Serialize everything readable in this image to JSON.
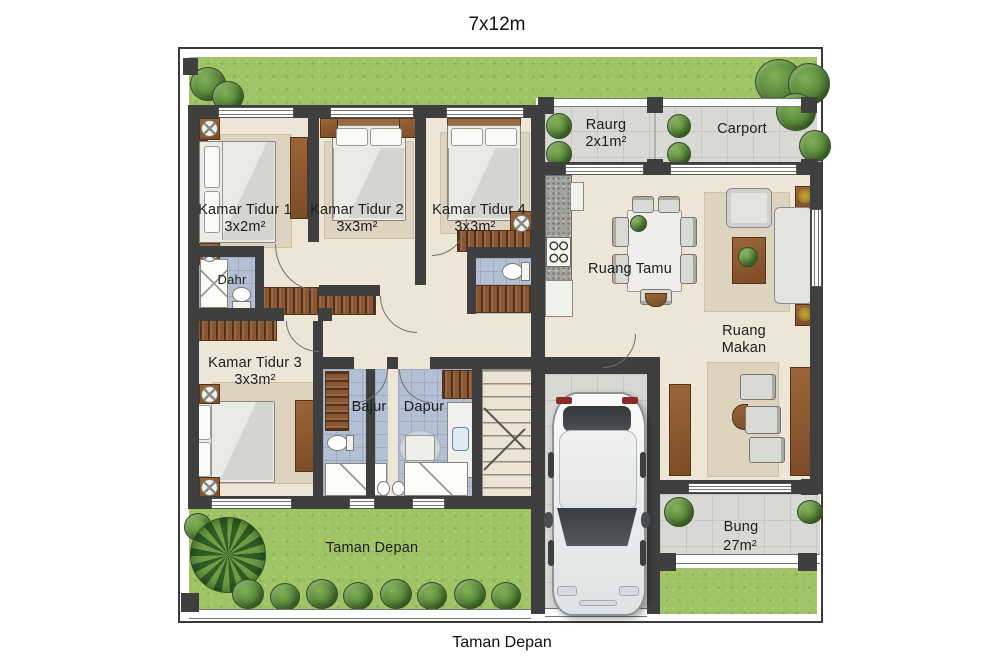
{
  "title": "7x12m",
  "caption": "Taman Depan",
  "rooms": {
    "bedroom1": {
      "label": "Kamar Tidur 1",
      "size": "3x2m²"
    },
    "bedroom2": {
      "label": "Kamar Tidur 2",
      "size": "3x3m²"
    },
    "bedroom4": {
      "label": "Kamar Tidur 4",
      "size": "3x3m²"
    },
    "bedroom3": {
      "label": "Kamar Tidur 3",
      "size": "3x3m²"
    },
    "bath_small": {
      "label": "Dahr"
    },
    "bathroom": {
      "label": "Bajur"
    },
    "kitchen": {
      "label": "Dapur"
    },
    "living": {
      "label": "Ruang Tamu"
    },
    "dining": {
      "line1": "Ruang",
      "line2": "Makan"
    },
    "porch": {
      "label": "Raurg",
      "size": "2x1m²"
    },
    "carport": {
      "label": "Carport"
    },
    "terrace": {
      "label": "Bung",
      "size": "27m²"
    },
    "garden": {
      "label": "Taman Depan"
    }
  },
  "colors": {
    "wall": "#3f3f3f",
    "floor": "#ede5d5",
    "lawn": "#a0c465",
    "paving": "#d8d8d4",
    "bath_tile": "#b3bfd2",
    "wood": "#8a5733",
    "rug": "#ded3bf",
    "car": "#f0f1f2",
    "text": "#1d1d1d"
  }
}
